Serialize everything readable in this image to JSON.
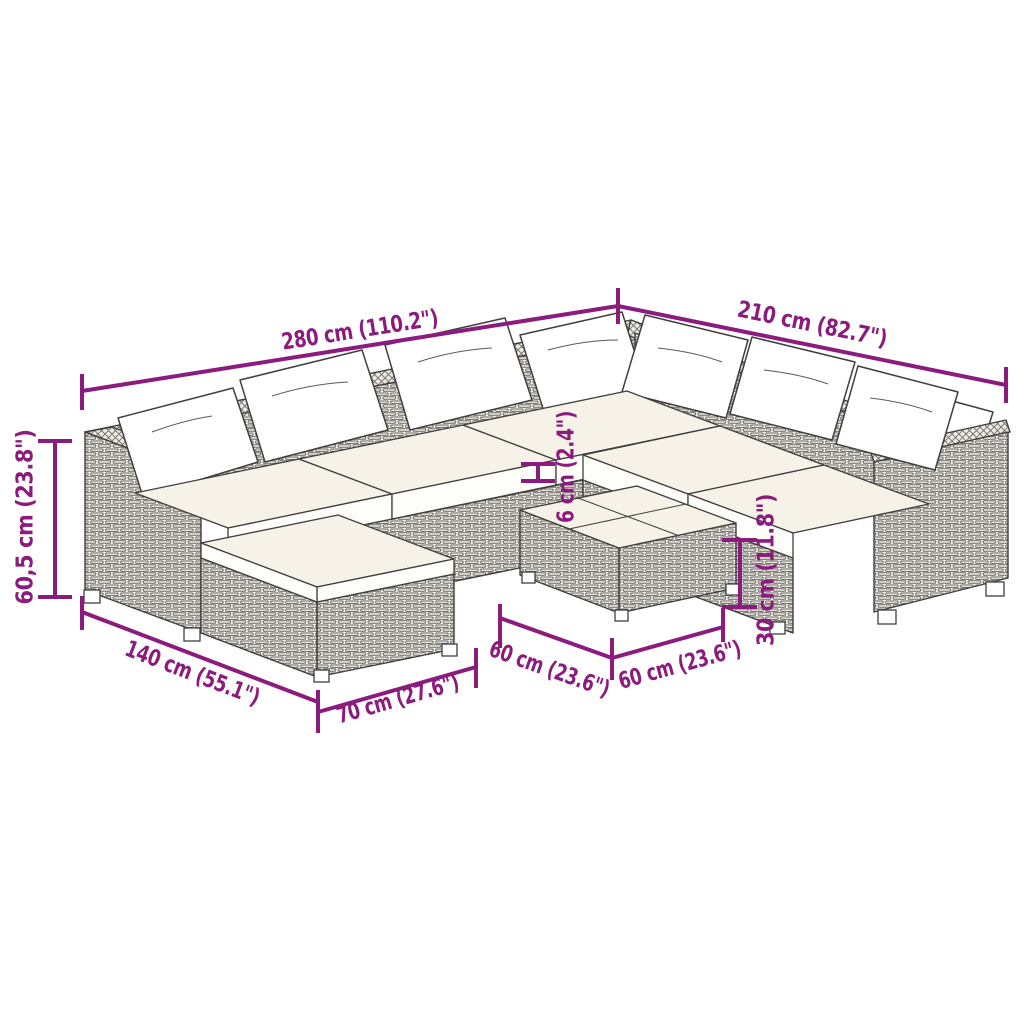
{
  "diagram": {
    "kind": "furniture-dimension-diagram",
    "subject": "poly rattan garden lounge set with cushions (corner sofa, footstool, coffee table)",
    "colors": {
      "accent": "#8c1b7e",
      "outline": "#3f3f3f",
      "cushion_top": "#f6f2e7",
      "cushion_side": "#fdfdfa",
      "wicker": "#f2efe9",
      "background": "#ffffff"
    },
    "dimensions": {
      "back_width": "280 cm (110.2\")",
      "side_width": "210 cm (82.7\")",
      "seat_height": "60,5 cm (23.8\")",
      "left_depth": "140 cm (55.1\")",
      "footstool_width": "70 cm (27.6\")",
      "table_width": "60 cm (23.6\")",
      "table_depth": "60 cm (23.6\")",
      "table_height": "30 cm (11.8\")",
      "cushion_thickness": "6 cm (2.4\")"
    }
  }
}
